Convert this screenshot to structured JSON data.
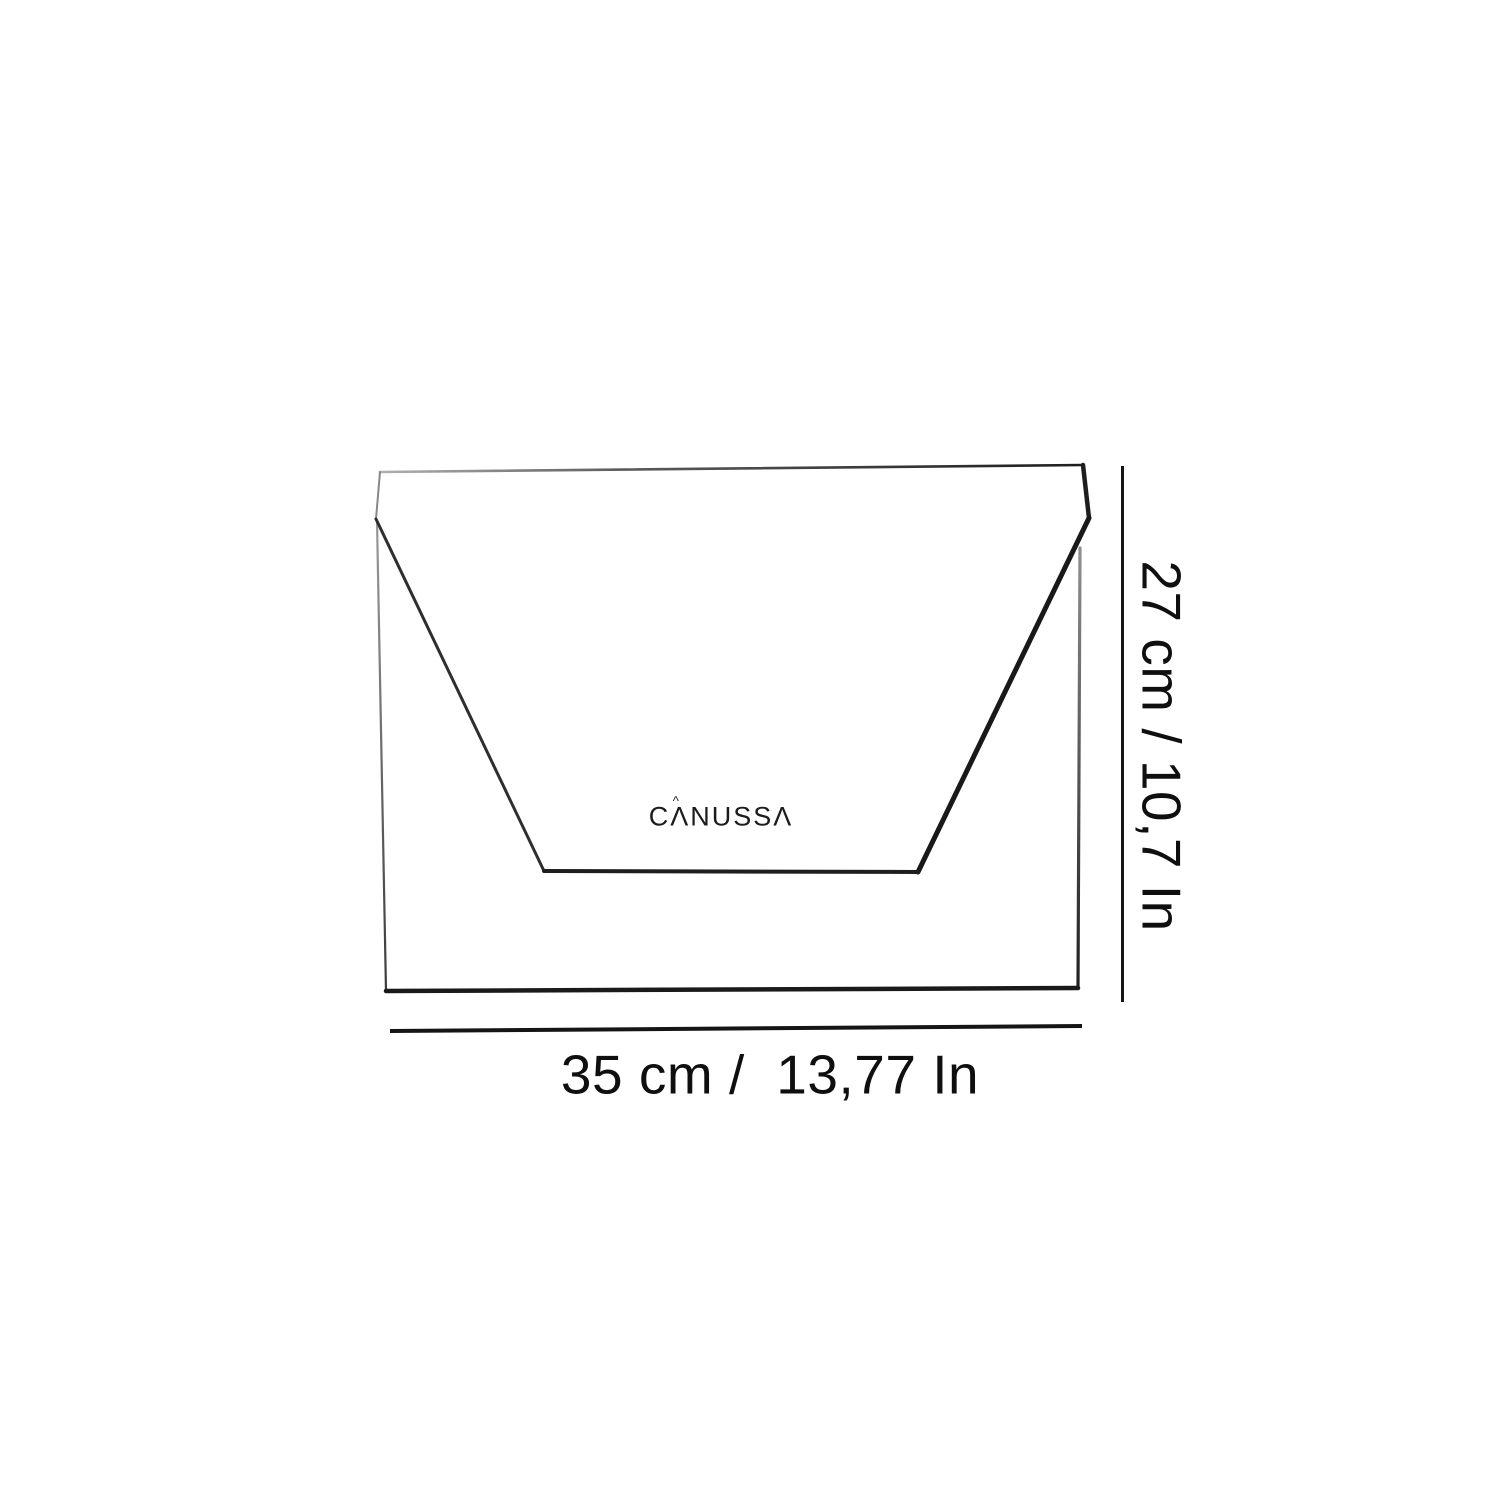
{
  "colors": {
    "background": "#ffffff",
    "ink": "#1e1e1e",
    "ink_soft": "#8a8a8a",
    "label_text": "#0f0f0f"
  },
  "logo": {
    "brand": "CANUSSA",
    "display_text": "CΛNUSSΛ",
    "accent_glyph": "^"
  },
  "dimensions": {
    "height_label": "27 cm / 10,7 In",
    "width_label": "35 cm /  13,77 In"
  }
}
